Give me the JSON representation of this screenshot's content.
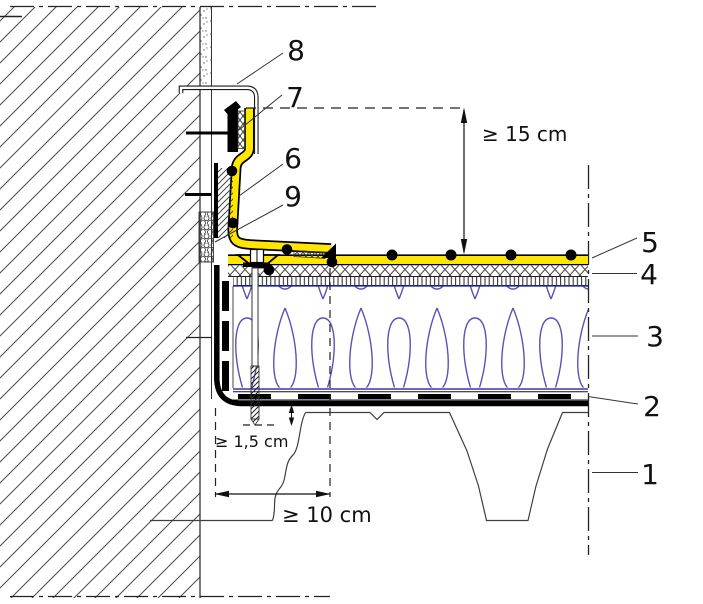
{
  "diagram": {
    "type": "construction-detail-section",
    "callouts": {
      "c1": "1",
      "c2": "2",
      "c3": "3",
      "c4": "4",
      "c5": "5",
      "c6": "6",
      "c7": "7",
      "c8": "8",
      "c9": "9"
    },
    "dimensions": {
      "upstand_height": "≥ 15 cm",
      "fastener_embedment": "≥ 1,5 cm",
      "edge_distance": "≥ 10 cm"
    },
    "colors": {
      "membrane_yellow": "#ffe600",
      "insulation_blue": "#5b50b5",
      "line_black": "#111111"
    }
  }
}
